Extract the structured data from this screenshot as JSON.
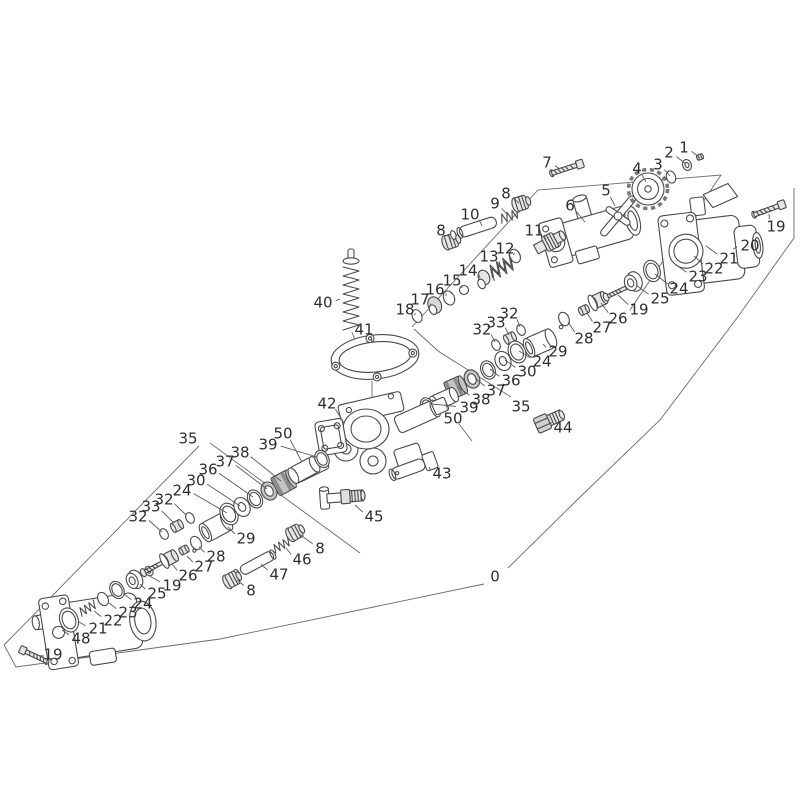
{
  "diagram": {
    "type": "exploded-parts-diagram",
    "background_color": "#ffffff",
    "line_color": "#4a4a4a",
    "label_color": "#2e2e2e",
    "label_font_size": 15,
    "callout_numbers": [
      "0",
      "1",
      "2",
      "3",
      "4",
      "5",
      "6",
      "7",
      "8",
      "9",
      "10",
      "11",
      "12",
      "13",
      "14",
      "15",
      "16",
      "17",
      "18",
      "19",
      "20",
      "21",
      "22",
      "23",
      "24",
      "25",
      "26",
      "27",
      "28",
      "29",
      "30",
      "32",
      "33",
      "35",
      "36",
      "37",
      "38",
      "39",
      "40",
      "41",
      "42",
      "43",
      "44",
      "45",
      "46",
      "47",
      "48",
      "50"
    ],
    "labels": [
      {
        "t": "1",
        "x": 684,
        "y": 147,
        "px": 699,
        "py": 157
      },
      {
        "t": "2",
        "x": 669,
        "y": 152,
        "px": 686,
        "py": 164
      },
      {
        "t": "3",
        "x": 658,
        "y": 164,
        "px": 670,
        "py": 176
      },
      {
        "t": "4",
        "x": 637,
        "y": 168,
        "px": 646,
        "py": 182
      },
      {
        "t": "5",
        "x": 606,
        "y": 190,
        "px": 615,
        "py": 206
      },
      {
        "t": "6",
        "x": 570,
        "y": 205,
        "px": 585,
        "py": 222
      },
      {
        "t": "7",
        "x": 547,
        "y": 162,
        "px": 560,
        "py": 169
      },
      {
        "t": "8",
        "x": 506,
        "y": 193,
        "px": 519,
        "py": 203
      },
      {
        "t": "9",
        "x": 495,
        "y": 203,
        "px": 507,
        "py": 214
      },
      {
        "t": "10",
        "x": 470,
        "y": 214,
        "px": 482,
        "py": 226
      },
      {
        "t": "8",
        "x": 441,
        "y": 230,
        "px": 451,
        "py": 239
      },
      {
        "t": "11",
        "x": 534,
        "y": 230,
        "px": 546,
        "py": 240
      },
      {
        "t": "12",
        "x": 505,
        "y": 248,
        "px": 513,
        "py": 255
      },
      {
        "t": "13",
        "x": 489,
        "y": 256,
        "px": 500,
        "py": 265
      },
      {
        "t": "14",
        "x": 468,
        "y": 270,
        "px": 480,
        "py": 278
      },
      {
        "t": "15",
        "x": 452,
        "y": 280,
        "px": 462,
        "py": 288
      },
      {
        "t": "16",
        "x": 435,
        "y": 289,
        "px": 446,
        "py": 296
      },
      {
        "t": "17",
        "x": 420,
        "y": 299,
        "px": 430,
        "py": 306
      },
      {
        "t": "18",
        "x": 405,
        "y": 309,
        "px": 414,
        "py": 315
      },
      {
        "t": "19",
        "x": 776,
        "y": 226,
        "px": 769,
        "py": 214
      },
      {
        "t": "20",
        "x": 750,
        "y": 245,
        "px": 733,
        "py": 249
      },
      {
        "t": "21",
        "x": 729,
        "y": 258,
        "px": 706,
        "py": 246
      },
      {
        "t": "22",
        "x": 714,
        "y": 268,
        "px": 694,
        "py": 256
      },
      {
        "t": "23",
        "x": 698,
        "y": 276,
        "px": 675,
        "py": 264
      },
      {
        "t": "24",
        "x": 679,
        "y": 288,
        "px": 655,
        "py": 274
      },
      {
        "t": "25",
        "x": 660,
        "y": 298,
        "px": 636,
        "py": 285
      },
      {
        "t": "19",
        "x": 639,
        "y": 309,
        "px": 618,
        "py": 295
      },
      {
        "t": "26",
        "x": 618,
        "y": 318,
        "px": 601,
        "py": 303
      },
      {
        "t": "27",
        "x": 602,
        "y": 327,
        "px": 587,
        "py": 313
      },
      {
        "t": "28",
        "x": 584,
        "y": 338,
        "px": 568,
        "py": 322
      },
      {
        "t": "32",
        "x": 509,
        "y": 313,
        "px": 520,
        "py": 327
      },
      {
        "t": "33",
        "x": 496,
        "y": 322,
        "px": 509,
        "py": 335
      },
      {
        "t": "32",
        "x": 482,
        "y": 329,
        "px": 495,
        "py": 342
      },
      {
        "t": "29",
        "x": 558,
        "y": 351,
        "px": 543,
        "py": 344
      },
      {
        "t": "24",
        "x": 542,
        "y": 361,
        "px": 519,
        "py": 351
      },
      {
        "t": "30",
        "x": 527,
        "y": 371,
        "px": 505,
        "py": 360
      },
      {
        "t": "36",
        "x": 511,
        "y": 380,
        "px": 490,
        "py": 369
      },
      {
        "t": "37",
        "x": 496,
        "y": 390,
        "px": 475,
        "py": 378
      },
      {
        "t": "38",
        "x": 481,
        "y": 399,
        "px": 458,
        "py": 387
      },
      {
        "t": "39",
        "x": 469,
        "y": 407,
        "px": 432,
        "py": 404
      },
      {
        "t": "35",
        "x": 521,
        "y": 406,
        "px": null,
        "py": null
      },
      {
        "t": "50",
        "x": 453,
        "y": 418,
        "px": 446,
        "py": 403
      },
      {
        "t": "44",
        "x": 563,
        "y": 427,
        "px": 551,
        "py": 422
      },
      {
        "t": "40",
        "x": 323,
        "y": 302,
        "px": 340,
        "py": 299
      },
      {
        "t": "41",
        "x": 364,
        "y": 329,
        "px": 372,
        "py": 342
      },
      {
        "t": "42",
        "x": 327,
        "y": 403,
        "px": 344,
        "py": 423
      },
      {
        "t": "43",
        "x": 442,
        "y": 473,
        "px": 429,
        "py": 467
      },
      {
        "t": "45",
        "x": 374,
        "y": 516,
        "px": 355,
        "py": 505
      },
      {
        "t": "35",
        "x": 188,
        "y": 438,
        "px": null,
        "py": null
      },
      {
        "t": "50",
        "x": 283,
        "y": 433,
        "px": 302,
        "py": 462
      },
      {
        "t": "39",
        "x": 268,
        "y": 444,
        "px": 317,
        "py": 457
      },
      {
        "t": "38",
        "x": 240,
        "y": 452,
        "px": 281,
        "py": 481
      },
      {
        "t": "37",
        "x": 225,
        "y": 461,
        "px": 267,
        "py": 489
      },
      {
        "t": "36",
        "x": 208,
        "y": 469,
        "px": 253,
        "py": 497
      },
      {
        "t": "30",
        "x": 196,
        "y": 480,
        "px": 240,
        "py": 506
      },
      {
        "t": "24",
        "x": 182,
        "y": 490,
        "px": 227,
        "py": 513
      },
      {
        "t": "32",
        "x": 164,
        "y": 499,
        "px": 186,
        "py": 515
      },
      {
        "t": "33",
        "x": 151,
        "y": 506,
        "px": 174,
        "py": 523
      },
      {
        "t": "32",
        "x": 138,
        "y": 516,
        "px": 162,
        "py": 532
      },
      {
        "t": "29",
        "x": 246,
        "y": 538,
        "px": 228,
        "py": 527
      },
      {
        "t": "28",
        "x": 216,
        "y": 556,
        "px": 199,
        "py": 547
      },
      {
        "t": "27",
        "x": 204,
        "y": 566,
        "px": 187,
        "py": 556
      },
      {
        "t": "26",
        "x": 188,
        "y": 575,
        "px": 172,
        "py": 564
      },
      {
        "t": "19",
        "x": 172,
        "y": 585,
        "px": 146,
        "py": 574
      },
      {
        "t": "25",
        "x": 157,
        "y": 593,
        "px": 140,
        "py": 584
      },
      {
        "t": "24",
        "x": 143,
        "y": 603,
        "px": 124,
        "py": 594
      },
      {
        "t": "23",
        "x": 128,
        "y": 612,
        "px": 109,
        "py": 603
      },
      {
        "t": "22",
        "x": 113,
        "y": 620,
        "px": 94,
        "py": 611
      },
      {
        "t": "21",
        "x": 98,
        "y": 628,
        "px": 79,
        "py": 622
      },
      {
        "t": "48",
        "x": 81,
        "y": 638,
        "px": 62,
        "py": 630
      },
      {
        "t": "19",
        "x": 53,
        "y": 654,
        "px": 44,
        "py": 656
      },
      {
        "t": "8",
        "x": 320,
        "y": 548,
        "px": 299,
        "py": 534
      },
      {
        "t": "46",
        "x": 302,
        "y": 559,
        "px": 286,
        "py": 548
      },
      {
        "t": "47",
        "x": 279,
        "y": 574,
        "px": 261,
        "py": 564
      },
      {
        "t": "8",
        "x": 251,
        "y": 590,
        "px": 237,
        "py": 580
      },
      {
        "t": "0",
        "x": 495,
        "y": 576,
        "px": null,
        "py": null
      }
    ]
  }
}
